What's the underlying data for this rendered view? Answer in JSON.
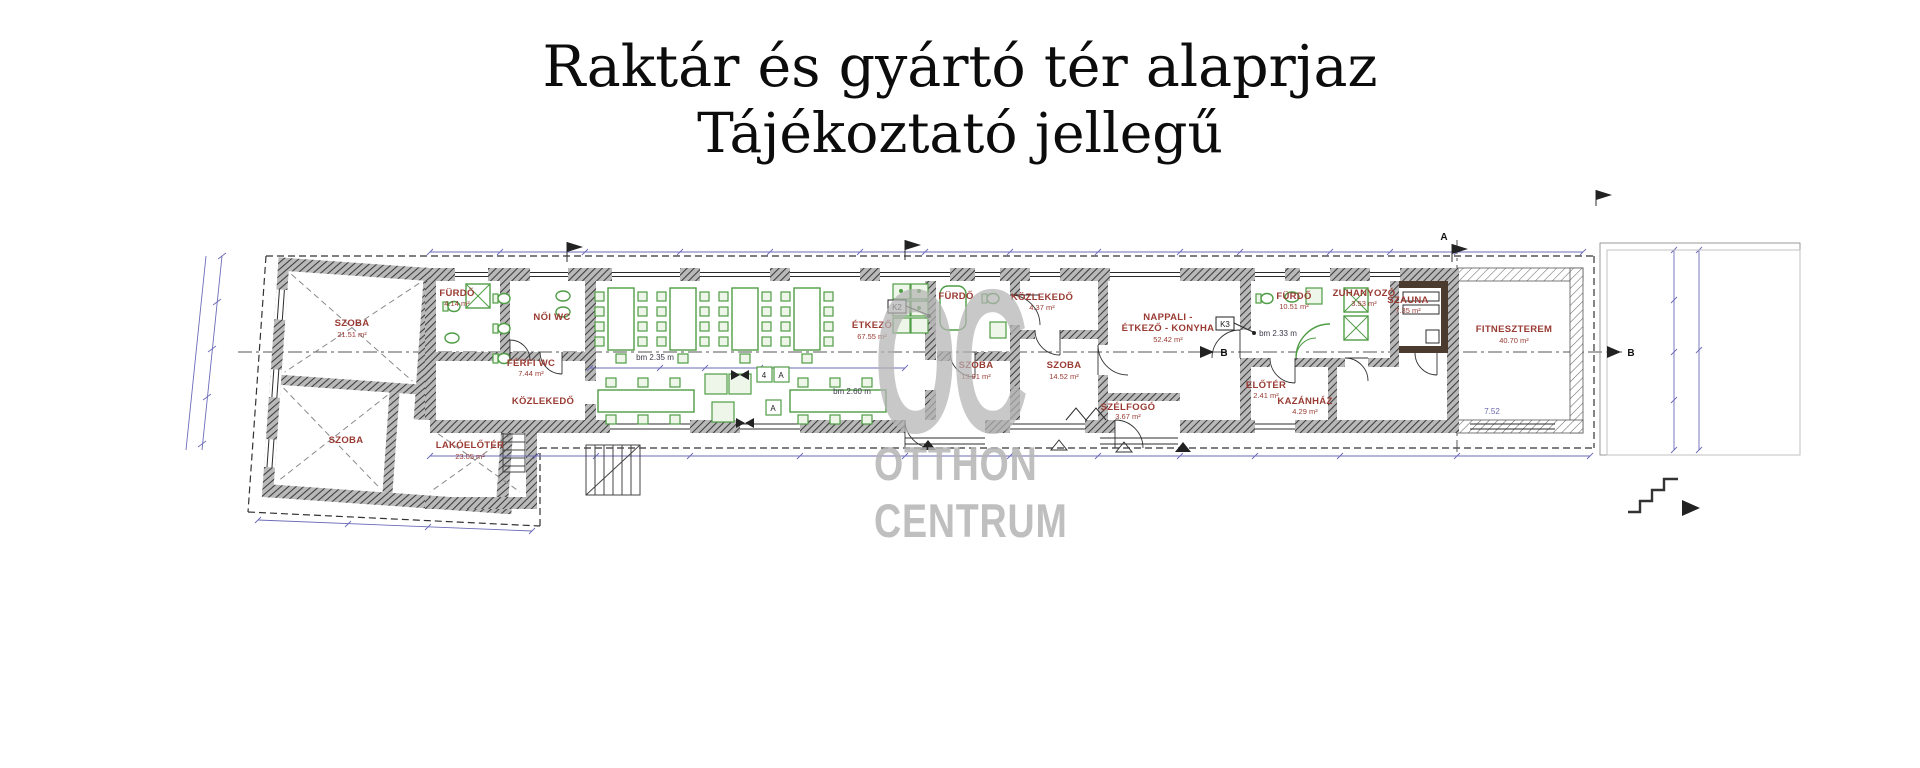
{
  "title": {
    "line1": "Raktár és gyártó tér alaprjaz",
    "line2": "Tájékoztató jellegű"
  },
  "watermark": {
    "monogram": "OC",
    "line1": "OTTHON",
    "line2": "CENTRUM"
  },
  "plan": {
    "rooms": [
      {
        "label": "SZOBA",
        "area": "21.51 m²"
      },
      {
        "label": "SZOBA"
      },
      {
        "label": "LAKÓELŐTÉR",
        "area": "23.05 m²"
      },
      {
        "label": "FÜRDŐ",
        "area": "4.14 m²"
      },
      {
        "label": "NŐI WC"
      },
      {
        "label": "FÉRFI WC",
        "area": "7.44 m²"
      },
      {
        "label": "KÖZLEKEDŐ"
      },
      {
        "label": "ÉTKEZŐ",
        "area": "67.55 m²"
      },
      {
        "label": "FÜRDŐ"
      },
      {
        "label": "KÖZLEKEDŐ",
        "area": "4.37 m²"
      },
      {
        "label": "SZOBA",
        "area": "13.91 m²"
      },
      {
        "label": "SZOBA",
        "area": "14.52 m²"
      },
      {
        "label": "NAPPALI -",
        "label2": "ÉTKEZŐ - KONYHA",
        "area": "52.42 m²"
      },
      {
        "label": "SZÉLFOGÓ",
        "area": "3.67 m²"
      },
      {
        "label": "FÜRDŐ",
        "area": "10.51 m²"
      },
      {
        "label": "ELŐTÉR",
        "area": "2.41 m²"
      },
      {
        "label": "KAZÁNHÁZ",
        "area": "4.29 m²"
      },
      {
        "label": "ZUHANYOZÓ",
        "area": "3.53 m²"
      },
      {
        "label": "SZAUNA",
        "area": "7.35 m²"
      },
      {
        "label": "FITNESZTEREM",
        "area": "40.70 m²"
      }
    ],
    "annotations": {
      "bm_etkezo": "bm 2.35 m",
      "bm_etkezo2": "bm 2.60 m",
      "bm_furdo": "bm 2.33 m",
      "dim_fitnesz": "7.52"
    },
    "markers": {
      "section_a": "A",
      "section_b": "B"
    },
    "tags": {
      "k2": "K2",
      "k3": "K3",
      "t4": "4",
      "ta": "A"
    }
  },
  "colors": {
    "room_label": "#993b33",
    "furniture_green": "#4f9d45",
    "dimension_line": "#6b6bb8",
    "wall_hatch": "#3c3c3c",
    "watermark_gray": "#b4b4b4"
  }
}
